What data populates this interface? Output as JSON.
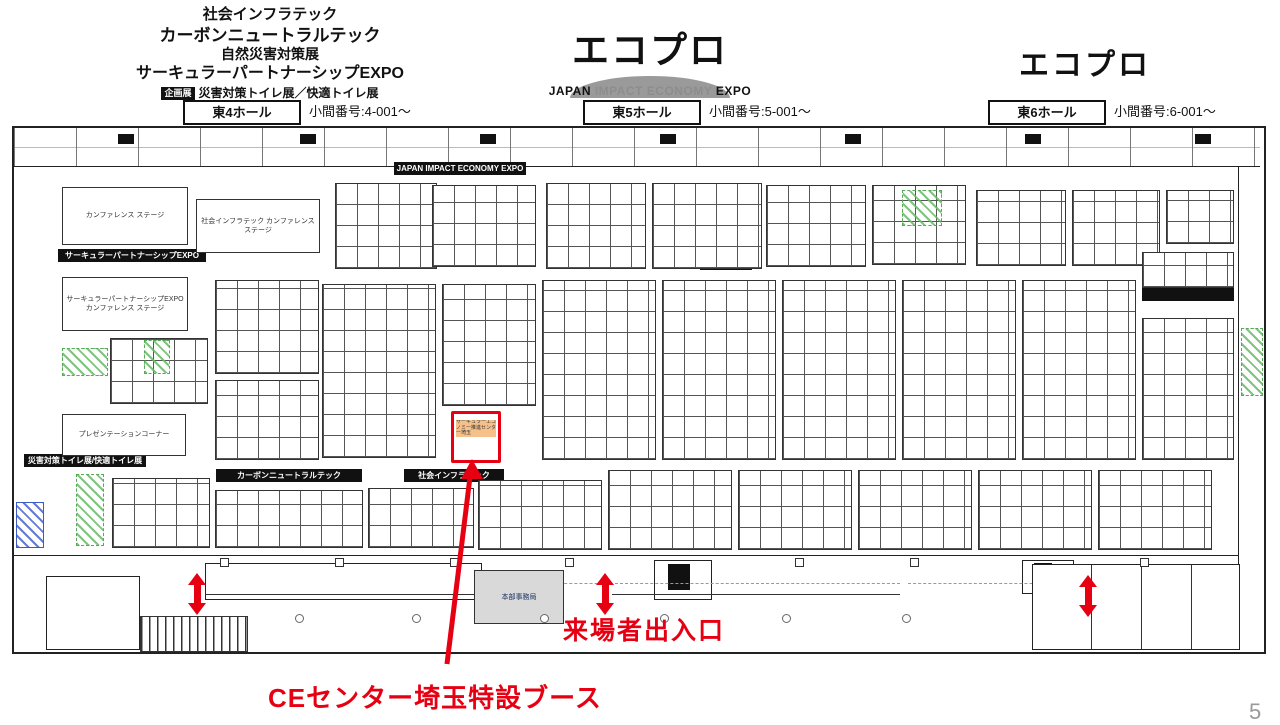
{
  "colors": {
    "red": "#e60012",
    "green_hatch": "#68ba68",
    "blue_hatch": "#3c5ac8",
    "gray_fill": "#d9d9d9"
  },
  "header": {
    "left_titles": [
      "社会インフラテック",
      "カーボンニュートラルテック",
      "自然災害対策展",
      "サーキュラーパートナーシップEXPO"
    ],
    "badge": "企画展",
    "left_sub": "災害対策トイレ展／快適トイレ展",
    "center_logo": "エコプロ",
    "sub_japan": "JAPAN",
    "sub_impact": "IMPACT ECONOMY",
    "sub_expo": "EXPO",
    "right_logo": "エコプロ"
  },
  "halls": [
    {
      "name": "東4ホール",
      "range": "小間番号:4-001〜"
    },
    {
      "name": "東5ホール",
      "range": "小間番号:5-001〜"
    },
    {
      "name": "東6ホール",
      "range": "小間番号:6-001〜"
    }
  ],
  "plan": {
    "top_banner": "JAPAN IMPACT ECONOMY EXPO",
    "zone_banners": {
      "circular_partnership": "サーキュラーパートナーシップEXPO",
      "carbon_neutral": "カーボンニュートラルテック",
      "social_infra": "社会インフラテック",
      "toilet_expo": "災害対策トイレ展/快適トイレ展"
    },
    "stages": {
      "conference_stage": "カンファレンス ステージ",
      "infra_conference_stage": "社会インフラテック カンファレンス ステージ",
      "circular_conference_stage": "サーキュラーパートナーシップEXPO カンファレンス ステージ",
      "presentation_corner": "プレゼンテーションコーナー"
    },
    "office": "本部事務局",
    "highlight_booth": "サーキュラーエコノミー推進センター埼玉"
  },
  "annotations": {
    "entrance_label": "来場者出入口",
    "booth_callout": "CEセンター埼玉特設ブース"
  },
  "page": {
    "number": "5"
  }
}
